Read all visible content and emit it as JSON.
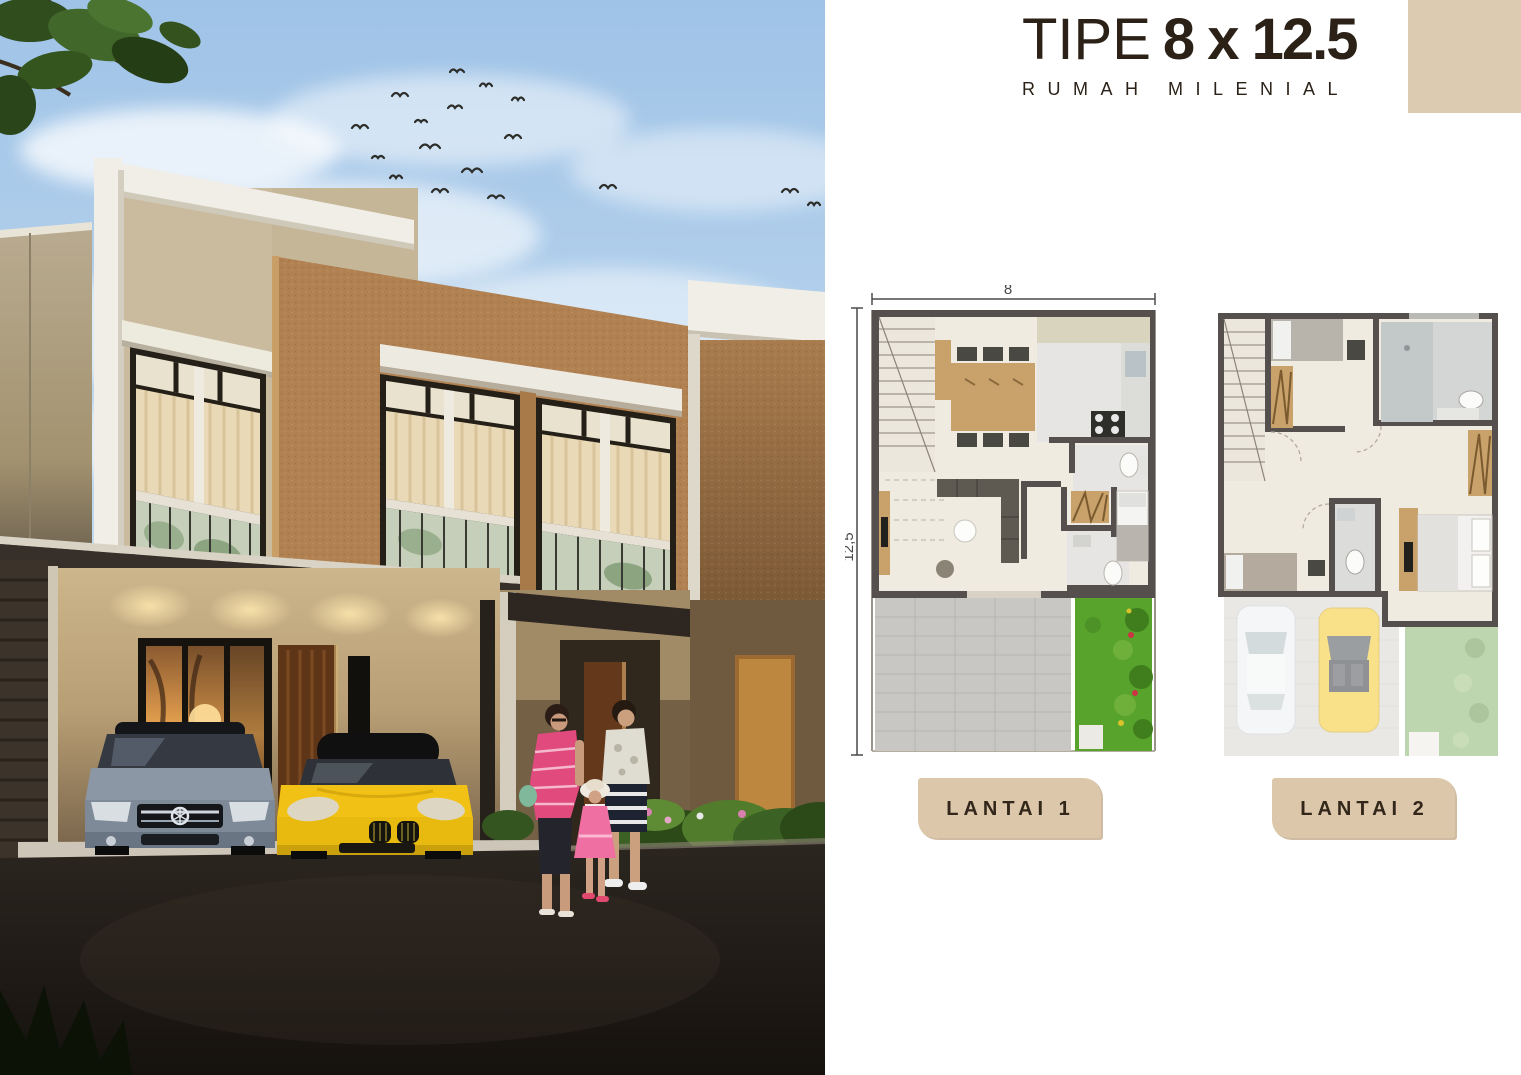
{
  "header": {
    "title_prefix": "TIPE",
    "title_size": "8 x 12.5",
    "subtitle": "RUMAH MILENIAL",
    "text_color": "#2b2117",
    "accent_color": "#dccbb0"
  },
  "plans": {
    "plan1": {
      "caption": "LANTAI 1",
      "width_label": "8",
      "height_label": "12,5"
    },
    "plan2": {
      "caption": "LANTAI 2"
    }
  },
  "photo": {
    "description": "Dusk render of a modern two-storey millennial townhouse with carport, a grey sedan and a yellow roadster parked, and a family of three walking along the street",
    "colors": {
      "sky_top": "#9fc3e7",
      "sky_bottom": "#e7f0f8",
      "wall_brown": "#b18151",
      "wall_white": "#f0eee6",
      "wall_beige": "#c6b698",
      "road": "#231e19",
      "car_grey": "#8b97a4",
      "car_yellow": "#f1c115",
      "garden_green": "#57a32b"
    }
  }
}
